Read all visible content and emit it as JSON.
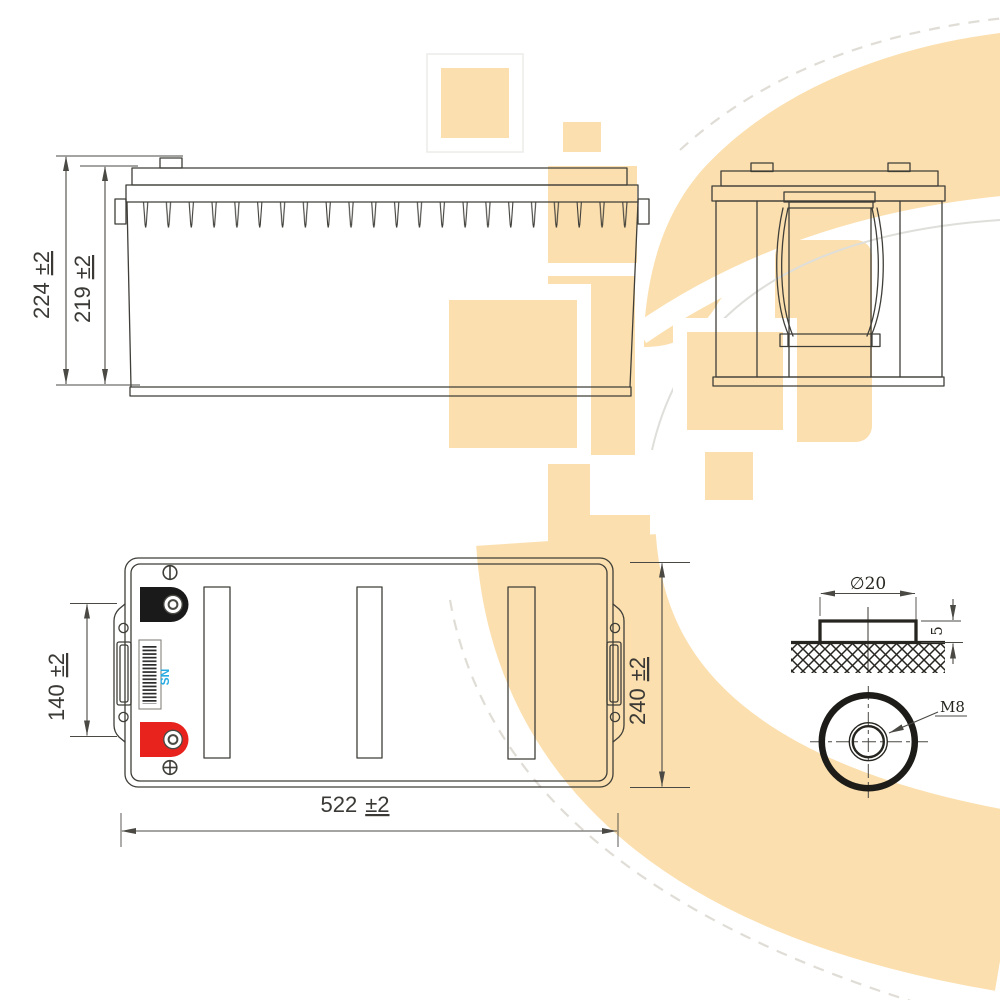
{
  "front_view": {
    "dim_height_total": {
      "value": "224",
      "tol": "±2"
    },
    "dim_height_case": {
      "value": "219",
      "tol": "±2"
    }
  },
  "top_view": {
    "dim_terminal_pitch": {
      "value": "140",
      "tol": "±2"
    },
    "dim_width": {
      "value": "240",
      "tol": "±2"
    },
    "dim_length": {
      "value": "522",
      "tol": "±2"
    },
    "serial_label": "SN"
  },
  "terminal_detail": {
    "dim_diameter": "∅20",
    "dim_height": "5",
    "thread_label": "M8"
  },
  "colors": {
    "line": "#3f3e39",
    "watermark": "#fbdfae",
    "negative_terminal": "#1a1a1a",
    "positive_terminal": "#e8231d",
    "serial_text": "#29abe2"
  }
}
